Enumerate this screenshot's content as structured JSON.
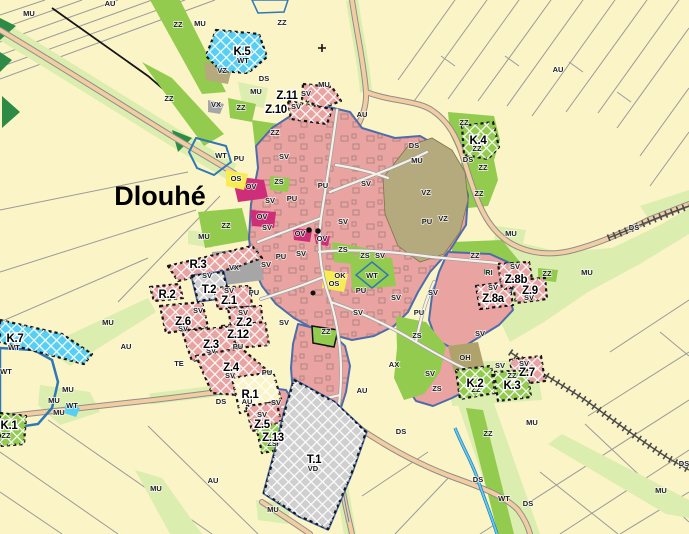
{
  "town": {
    "name": "Dlouhé"
  },
  "labels": {
    "zone_ids": [
      [
        "K.5",
        242,
        55
      ],
      [
        "Z.11",
        287,
        99
      ],
      [
        "Z.10",
        276,
        113
      ],
      [
        "K.4",
        478,
        144
      ],
      [
        "R.3",
        198,
        268
      ],
      [
        "R.2",
        167,
        298
      ],
      [
        "T.2",
        209,
        293
      ],
      [
        "Z.1",
        229,
        304
      ],
      [
        "Z.6",
        183,
        325
      ],
      [
        "Z.2",
        244,
        326
      ],
      [
        "Z.12",
        238,
        338
      ],
      [
        "Z.3",
        211,
        348
      ],
      [
        "Z.4",
        231,
        371
      ],
      [
        "R.1",
        250,
        398
      ],
      [
        "Z.5",
        262,
        428
      ],
      [
        "Z.13",
        273,
        441
      ],
      [
        "T.1",
        314,
        463
      ],
      [
        "K.7",
        15,
        342
      ],
      [
        "K.1",
        9,
        429
      ],
      [
        "Z.8a",
        493,
        302
      ],
      [
        "Z.8b",
        516,
        283
      ],
      [
        "Z.9",
        530,
        294
      ],
      [
        "Z.7",
        527,
        376
      ],
      [
        "K.2",
        475,
        387
      ],
      [
        "K.3",
        512,
        389
      ]
    ],
    "area_codes": [
      [
        "AU",
        110,
        6
      ],
      [
        "AU",
        558,
        72
      ],
      [
        "AU",
        362,
        117
      ],
      [
        "AU",
        126,
        349
      ],
      [
        "AU",
        247,
        404
      ],
      [
        "AU",
        362,
        393
      ],
      [
        "AU",
        213,
        483
      ],
      [
        "AX",
        394,
        367
      ],
      [
        "MU",
        29,
        16
      ],
      [
        "MU",
        200,
        26
      ],
      [
        "MU",
        256,
        94
      ],
      [
        "MU",
        324,
        87
      ],
      [
        "MU",
        417,
        163
      ],
      [
        "MU",
        511,
        236
      ],
      [
        "MU",
        587,
        275
      ],
      [
        "MU",
        204,
        239
      ],
      [
        "MU",
        108,
        325
      ],
      [
        "MU",
        68,
        392
      ],
      [
        "MU",
        54,
        403
      ],
      [
        "MU",
        59,
        415
      ],
      [
        "MU",
        156,
        491
      ],
      [
        "MU",
        273,
        512
      ],
      [
        "MU",
        532,
        425
      ],
      [
        "MU",
        661,
        493
      ],
      [
        "ZZ",
        178,
        27
      ],
      [
        "ZZ",
        169,
        101
      ],
      [
        "ZZ",
        282,
        25
      ],
      [
        "ZZ",
        464,
        125
      ],
      [
        "ZZ",
        477,
        151
      ],
      [
        "ZZ",
        483,
        170
      ],
      [
        "ZZ",
        479,
        196
      ],
      [
        "ZZ",
        241,
        110
      ],
      [
        "ZZ",
        275,
        135
      ],
      [
        "ZZ",
        226,
        228
      ],
      [
        "ZZ",
        475,
        258
      ],
      [
        "ZZ",
        547,
        276
      ],
      [
        "ZZ",
        512,
        378
      ],
      [
        "ZZ",
        476,
        392
      ],
      [
        "ZZ",
        326,
        334
      ],
      [
        "ZZ",
        488,
        436
      ],
      [
        "ZZ",
        6,
        438
      ],
      [
        "VZ",
        222,
        73
      ],
      [
        "VZ",
        426,
        195
      ],
      [
        "VZ",
        443,
        221
      ],
      [
        "VX",
        216,
        107
      ],
      [
        "VX",
        234,
        270
      ],
      [
        "WT",
        221,
        158
      ],
      [
        "WT",
        243,
        63
      ],
      [
        "WT",
        372,
        278
      ],
      [
        "WT",
        14,
        350
      ],
      [
        "WT",
        6,
        374
      ],
      [
        "WT",
        72,
        408
      ],
      [
        "WT",
        504,
        501
      ],
      [
        "DS",
        264,
        81
      ],
      [
        "DS",
        414,
        148
      ],
      [
        "DS",
        468,
        162
      ],
      [
        "DS",
        634,
        230
      ],
      [
        "DS",
        401,
        434
      ],
      [
        "DS",
        478,
        482
      ],
      [
        "DS",
        528,
        506
      ],
      [
        "DS",
        221,
        404
      ],
      [
        "DS",
        684,
        466
      ],
      [
        "SV",
        306,
        96
      ],
      [
        "SV",
        296,
        109
      ],
      [
        "SV",
        284,
        159
      ],
      [
        "SV",
        366,
        186
      ],
      [
        "SV",
        343,
        224
      ],
      [
        "SV",
        270,
        203
      ],
      [
        "SV",
        267,
        230
      ],
      [
        "SV",
        301,
        256
      ],
      [
        "SV",
        266,
        267
      ],
      [
        "SV",
        396,
        300
      ],
      [
        "SV",
        433,
        295
      ],
      [
        "SV",
        358,
        315
      ],
      [
        "SV",
        380,
        258
      ],
      [
        "SV",
        207,
        278
      ],
      [
        "SV",
        229,
        293
      ],
      [
        "SV",
        198,
        313
      ],
      [
        "SV",
        183,
        331
      ],
      [
        "SV",
        243,
        315
      ],
      [
        "SV",
        284,
        325
      ],
      [
        "SV",
        211,
        353
      ],
      [
        "SV",
        230,
        378
      ],
      [
        "SV",
        276,
        405
      ],
      [
        "SV",
        262,
        417
      ],
      [
        "SV",
        430,
        376
      ],
      [
        "SV",
        480,
        336
      ],
      [
        "SV",
        500,
        368
      ],
      [
        "SV",
        524,
        366
      ],
      [
        "SV",
        515,
        269
      ],
      [
        "SV",
        493,
        290
      ],
      [
        "SV",
        529,
        300
      ],
      [
        "PU",
        239,
        161
      ],
      [
        "PU",
        292,
        201
      ],
      [
        "PU",
        323,
        188
      ],
      [
        "PU",
        427,
        224
      ],
      [
        "PU",
        281,
        259
      ],
      [
        "PU",
        254,
        295
      ],
      [
        "PU",
        238,
        349
      ],
      [
        "PU",
        267,
        375
      ],
      [
        "PU",
        361,
        293
      ],
      [
        "PU",
        419,
        315
      ],
      [
        "OV",
        251,
        189
      ],
      [
        "OV",
        262,
        219
      ],
      [
        "OV",
        300,
        236
      ],
      [
        "OV",
        322,
        241
      ],
      [
        "OS",
        236,
        181
      ],
      [
        "OS",
        334,
        286
      ],
      [
        "OK",
        340,
        278
      ],
      [
        "ZS",
        279,
        184
      ],
      [
        "ZS",
        343,
        252
      ],
      [
        "ZS",
        365,
        258
      ],
      [
        "ZS",
        417,
        338
      ],
      [
        "ZS",
        437,
        391
      ],
      [
        "ZS",
        272,
        446
      ],
      [
        "OH",
        465,
        360
      ],
      [
        "RI",
        489,
        275
      ],
      [
        "TE",
        179,
        366
      ],
      [
        "VD",
        313,
        471
      ]
    ]
  },
  "colors": {
    "field": "#fbf4c6",
    "light_green": "#dcedb0",
    "green": "#93cb4f",
    "dark_green": "#2e8b45",
    "built_up": "#e9a3a1",
    "civic_magenta": "#ce2e78",
    "sport_yellow": "#f7ec52",
    "farm_olive": "#b4aa7d",
    "olive_dark": "#b0a26b",
    "industry_gray": "#a6a6a6",
    "tech_gray": "#cfcfcf",
    "water": "#58cff2",
    "water_border": "#2d78b5",
    "road": "#f2cda1",
    "road_edge": "#8e8e8e",
    "parcel_line": "#9a9a9a",
    "boundary_blue": "#4c6cac",
    "rail": "#4a4a4a"
  }
}
